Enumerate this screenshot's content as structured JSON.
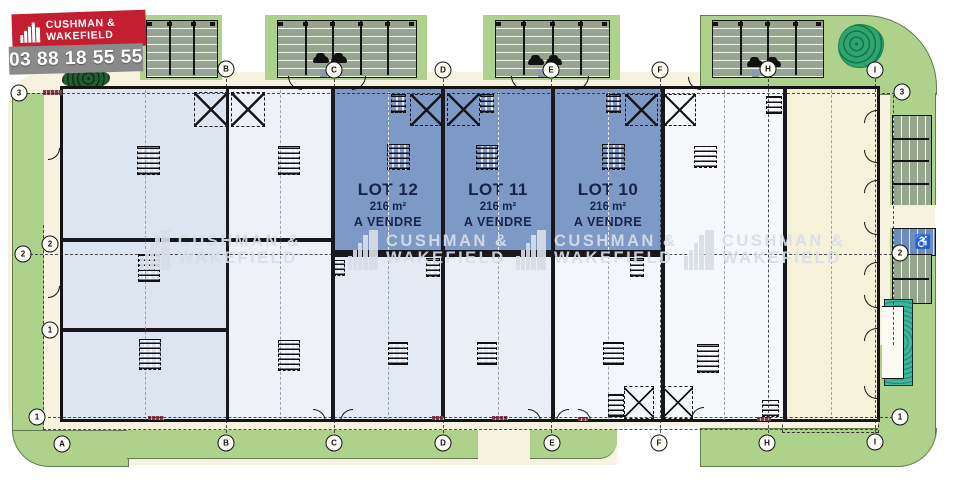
{
  "branding": {
    "company_line1": "CUSHMAN &",
    "company_line2": "WAKEFIELD",
    "phone": "03 88 18 55 55",
    "brand_red": "#c41e31",
    "phone_bar_gray": "#8a8a8a"
  },
  "watermark": {
    "line1": "CUSHMAN &",
    "line2": "WAKEFIELD"
  },
  "site": {
    "lots": [
      {
        "name": "LOT 12",
        "area": "216 m²",
        "status": "A VENDRE"
      },
      {
        "name": "LOT 11",
        "area": "216 m²",
        "status": "A VENDRE"
      },
      {
        "name": "LOT 10",
        "area": "216 m²",
        "status": "A VENDRE"
      }
    ]
  },
  "grid_markers": {
    "top": [
      "B",
      "C",
      "D",
      "E",
      "F",
      "H",
      "I"
    ],
    "bottom": [
      "A",
      "B",
      "C",
      "D",
      "E",
      "F",
      "H",
      "I"
    ],
    "left_outer": [
      "3",
      "2",
      "1"
    ],
    "left_inner": [
      "2",
      "1"
    ],
    "right": [
      "3",
      "2",
      "1"
    ]
  },
  "icons": {
    "accessible_parking": "♿"
  },
  "colors": {
    "lot_for_sale_blue": "#7d99c6",
    "landscape_green": "#aed18c",
    "parking_stall_sage": "#96a58e",
    "circulation_cream": "#f7f3e0",
    "accessible_parking_blue": "#6d8cbd",
    "unit_light_blue": "#dce5f0",
    "warehouse_cream": "#f6f2da"
  }
}
